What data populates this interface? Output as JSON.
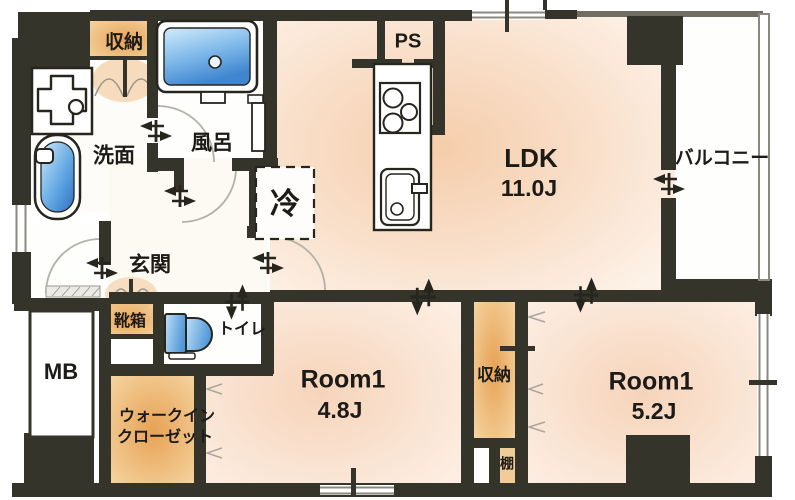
{
  "rooms": {
    "ldk": {
      "label": "LDK",
      "size": "11.0J"
    },
    "room1a": {
      "label": "Room1",
      "size": "4.8J"
    },
    "room1b": {
      "label": "Room1",
      "size": "5.2J"
    },
    "balcony": {
      "label": "バルコニー"
    },
    "bath": {
      "label": "風呂"
    },
    "washroom": {
      "label": "洗面"
    },
    "toilet": {
      "label": "トイレ"
    },
    "entrance": {
      "label": "玄関"
    },
    "walkin_closet": {
      "line1": "ウォークイン",
      "line2": "クローゼット"
    },
    "storage_top": {
      "label": "収納"
    },
    "storage_mid": {
      "label": "収納"
    },
    "shelf": {
      "label": "棚"
    },
    "shoe_box": {
      "label": "靴箱"
    },
    "meter_box": {
      "label": "MB"
    },
    "pipe_space": {
      "label": "PS"
    },
    "refrigerator": {
      "label": "冷"
    }
  },
  "icons": [
    "bathtub-icon",
    "washing-machine-pan-icon",
    "wash-basin-icon",
    "toilet-icon",
    "stove-icon",
    "kitchen-sink-icon",
    "door-swing-arc-icon",
    "door-direction-arrow-icon",
    "folding-door-icon"
  ],
  "colors": {
    "wall": "#35342a",
    "storage_orange": "#e8a45f",
    "room_pink": "#f6d0b2",
    "fixture_blue": "#5b9fdd",
    "arc_gray": "#b3b1a8"
  }
}
